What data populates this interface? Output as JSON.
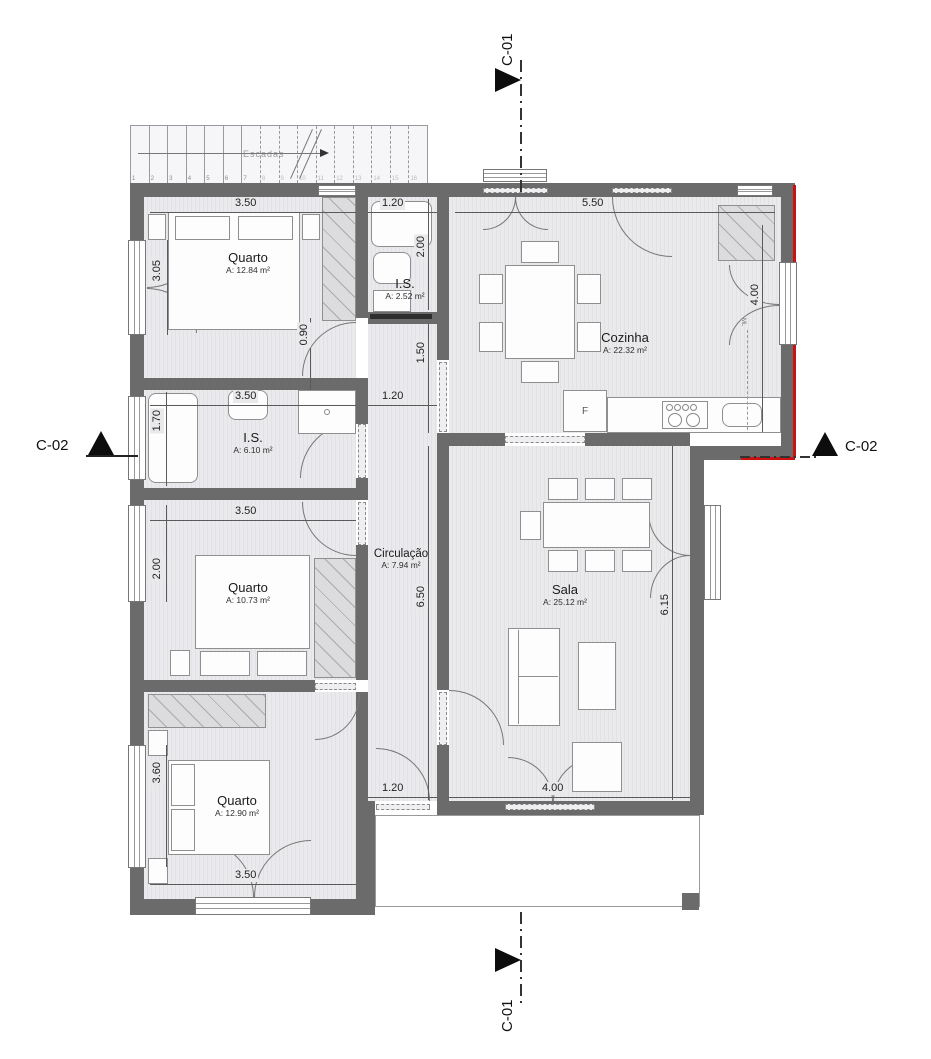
{
  "markers": {
    "c01": "C-01",
    "c02": "C-02"
  },
  "stairs": {
    "label": "Escadas",
    "treads": [
      "1",
      "2",
      "3",
      "4",
      "5",
      "6",
      "7",
      "8",
      "9",
      "10",
      "11",
      "12",
      "13",
      "14",
      "15",
      "16"
    ]
  },
  "rooms": {
    "quarto1": {
      "name": "Quarto",
      "area": "A: 12.84 m²"
    },
    "is1": {
      "name": "I.S.",
      "area": "A: 2.52 m²"
    },
    "cozinha": {
      "name": "Cozinha",
      "area": "A: 22.32 m²"
    },
    "is2": {
      "name": "I.S.",
      "area": "A: 6.10 m²"
    },
    "quarto2": {
      "name": "Quarto",
      "area": "A: 10.73 m²"
    },
    "circulacao": {
      "name": "Circulação",
      "area": "A: 7.94 m²"
    },
    "sala": {
      "name": "Sala",
      "area": "A: 25.12 m²"
    },
    "quarto3": {
      "name": "Quarto",
      "area": "A: 12.90 m²"
    }
  },
  "appliances": {
    "fridge": "F",
    "washing_machine": "ML"
  },
  "dims": {
    "q1_top": "3.50",
    "is1_top": "1.20",
    "coz_top": "5.50",
    "q1_win": "3.05",
    "is1_right": "2.00",
    "coz_win": "4.00",
    "hall_090": "0.90",
    "hall_150": "1.50",
    "is2_top": "3.50",
    "is2_right": "1.20",
    "is2_win": "1.70",
    "q2_top": "3.50",
    "q2_win": "2.00",
    "hall_len": "6.50",
    "sala_right": "6.15",
    "q3_win": "3.60",
    "hall_exit": "1.20",
    "sala_bottom": "4.00",
    "q3_bottom": "3.50"
  },
  "colors": {
    "wall": "#6b6b6b",
    "accent_red": "#cc1111",
    "floor": "#e8e8ec"
  }
}
